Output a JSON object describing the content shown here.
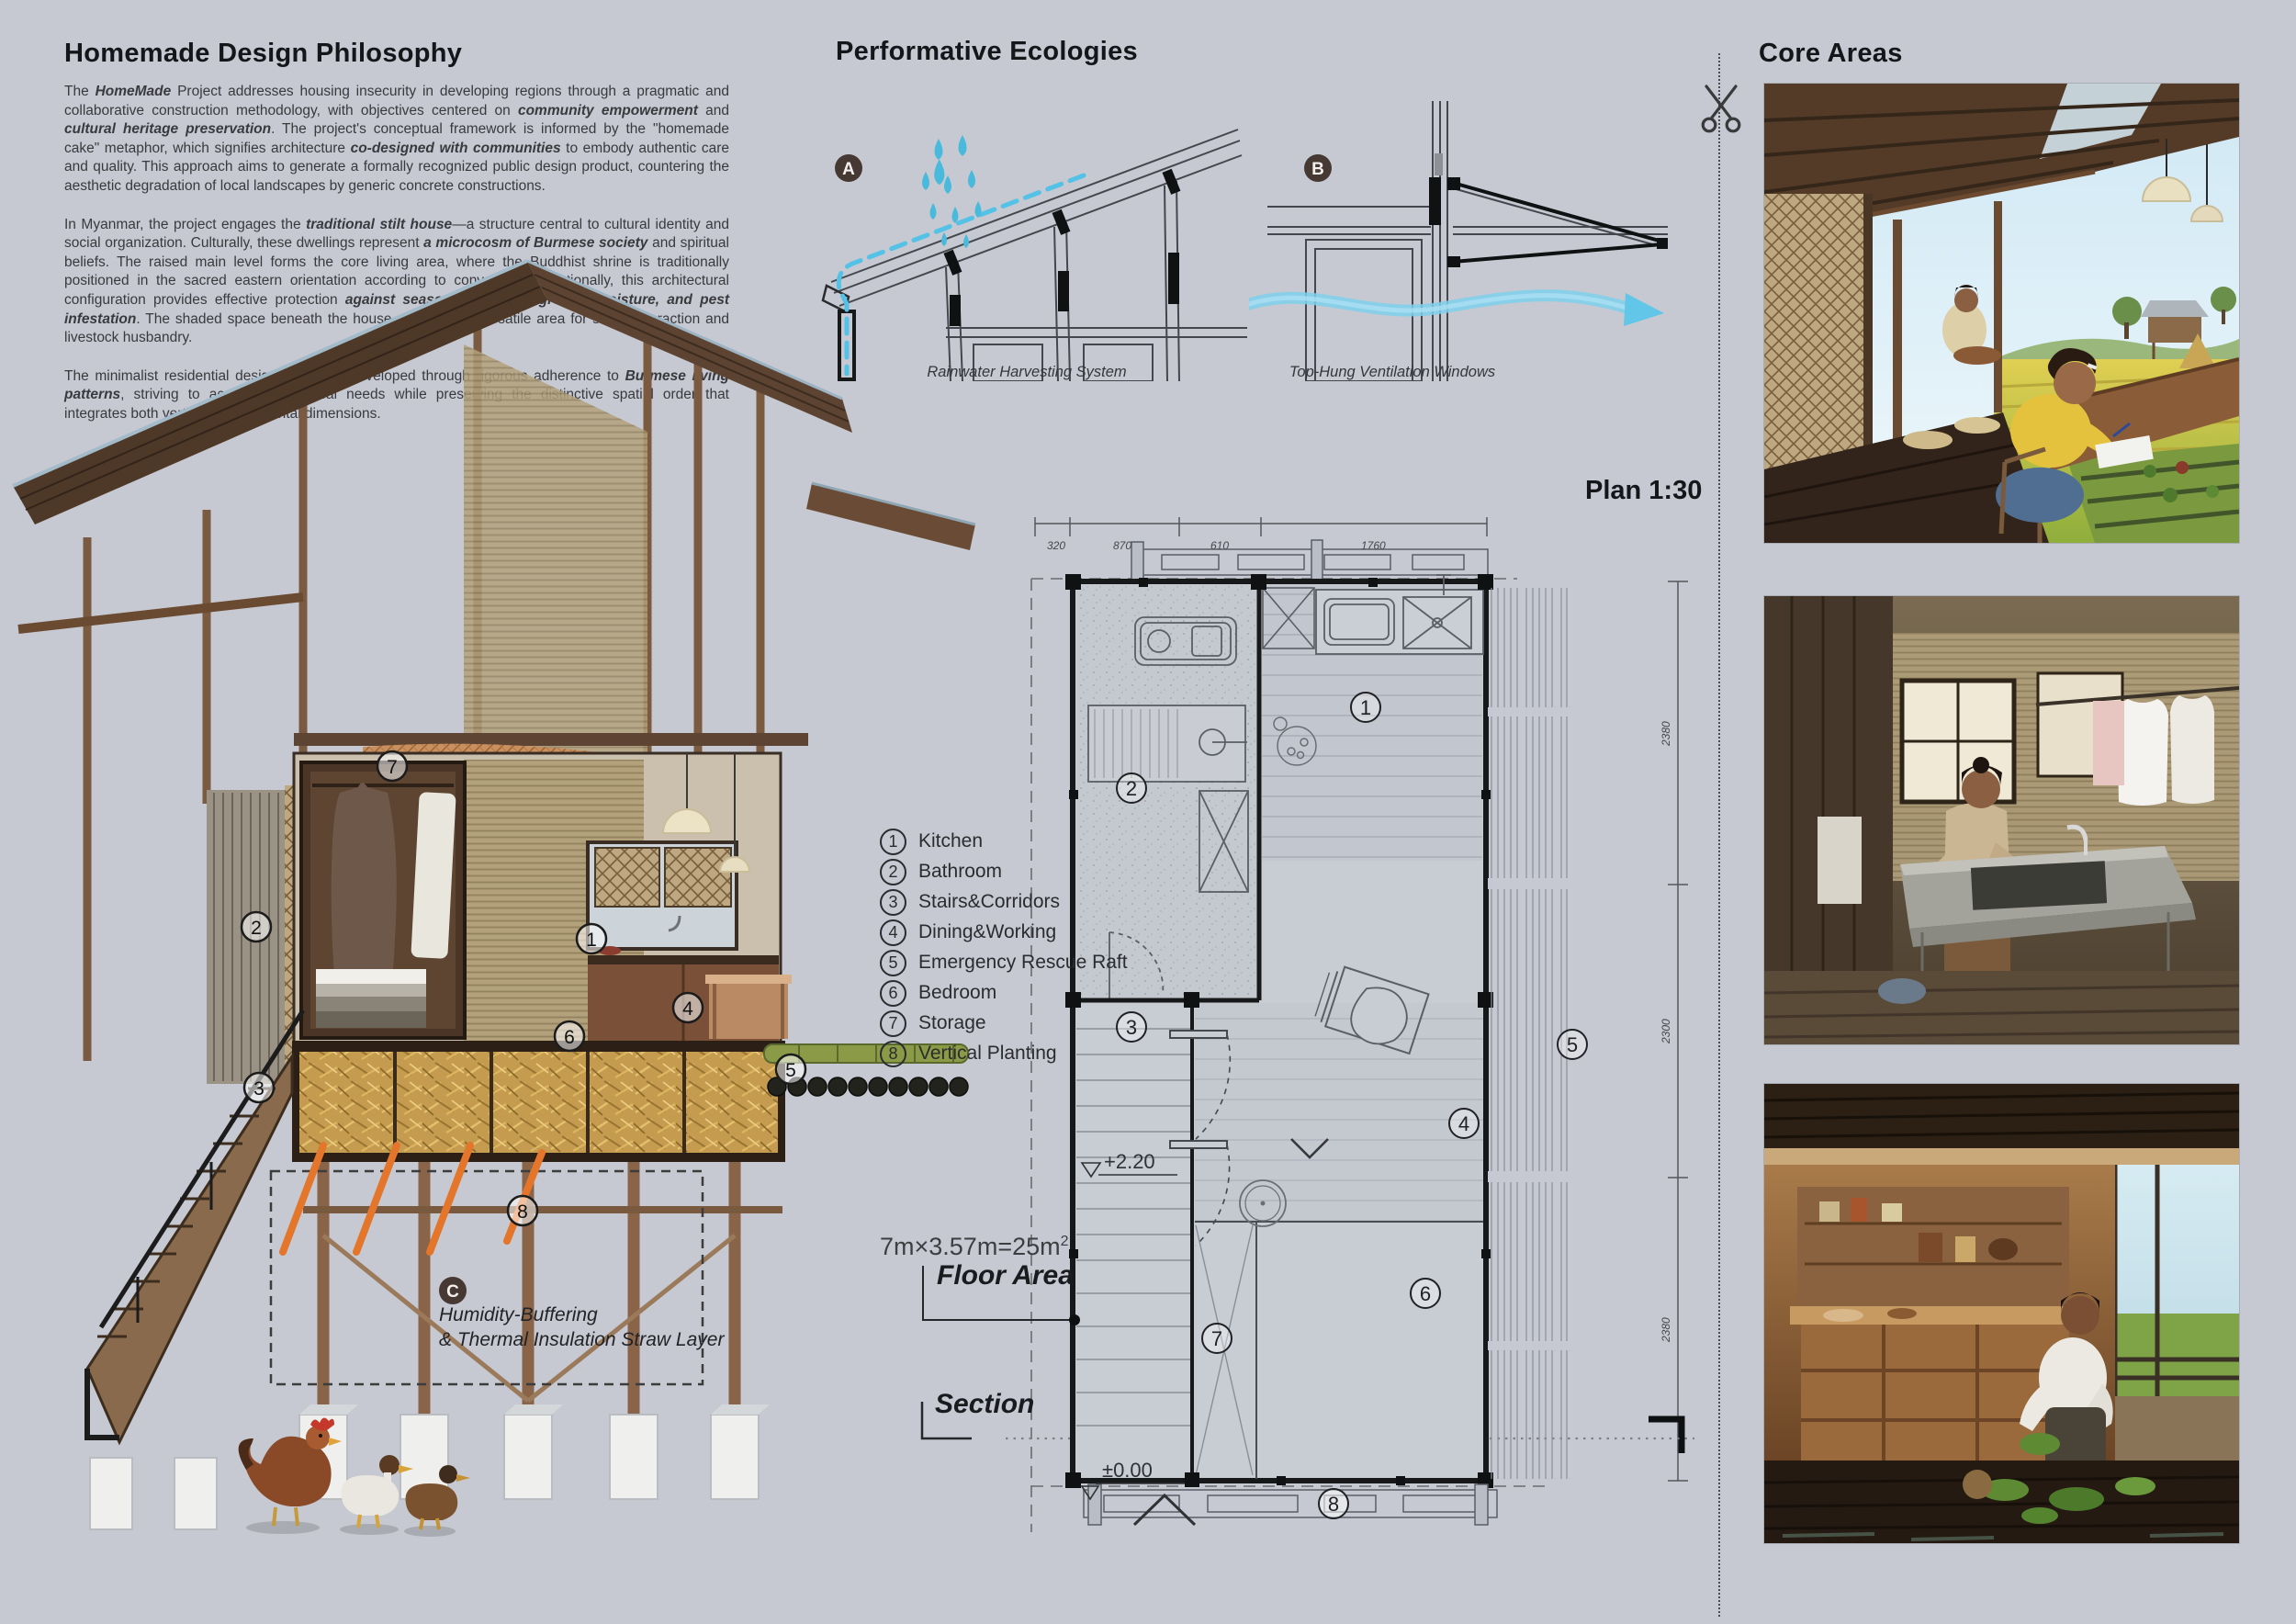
{
  "philosophy": {
    "title": "Homemade Design Philosophy",
    "p1": [
      {
        "t": "The "
      },
      {
        "t": "HomeMade"
      },
      {
        "t": " Project addresses housing insecurity in developing regions through a pragmatic and collaborative construction methodology, with objectives centered on "
      },
      {
        "t": "community empowerment"
      },
      {
        "t": " and "
      },
      {
        "t": "cultural heritage preservation"
      },
      {
        "t": ". The project's conceptual framework is informed by the \"homemade cake\" metaphor, which signifies architecture "
      },
      {
        "t": "co-designed with communities"
      },
      {
        "t": " to embody authentic care and quality. This approach aims to generate a formally recognized public design product, countering the aesthetic degradation of local landscapes by generic concrete constructions."
      }
    ],
    "p2": [
      {
        "t": "In Myanmar, the project engages the "
      },
      {
        "t": "traditional stilt house"
      },
      {
        "t": "—a structure central to cultural identity and social organization. Culturally, these dwellings represent "
      },
      {
        "t": "a microcosm of Burmese society"
      },
      {
        "t": " and spiritual beliefs. The raised main level forms the core living area, where the Buddhist shrine is traditionally positioned in the sacred eastern orientation according to convention. Functionally, this architectural configuration provides effective protection "
      },
      {
        "t": "against seasonal flooding, ground moisture, and pest infestation"
      },
      {
        "t": ". The shaded space beneath the house serves as a versatile area for social interaction and livestock husbandry."
      }
    ],
    "p3": [
      {
        "t": "The minimalist residential design has been developed through rigorous adherence to "
      },
      {
        "t": "Burmese living patterns"
      },
      {
        "t": ", striving to accommodate local needs while preserving the distinctive spatial order that integrates both vertical and horizontal dimensions."
      }
    ]
  },
  "ecologies": {
    "title": "Performative Ecologies",
    "a_label": "A",
    "a_caption": "Rainwater Harvesting System",
    "b_label": "B",
    "b_caption": "Top-Hung Ventilation Windows"
  },
  "plan": {
    "title": "Plan 1:30",
    "legend": [
      {
        "num": "1",
        "label": "Kitchen"
      },
      {
        "num": "2",
        "label": "Bathroom"
      },
      {
        "num": "3",
        "label": "Stairs&Corridors"
      },
      {
        "num": "4",
        "label": "Dining&Working"
      },
      {
        "num": "5",
        "label": "Emergency Rescue Raft"
      },
      {
        "num": "6",
        "label": "Bedroom"
      },
      {
        "num": "7",
        "label": "Storage"
      },
      {
        "num": "8",
        "label": "Vertical Planting"
      }
    ],
    "dims_top": [
      "320",
      "870",
      "610",
      "1760"
    ],
    "dims_right": [
      "2380",
      "2300",
      "2380"
    ],
    "level_upper": "+2.20",
    "level_ground": "±0.00",
    "floor_area": {
      "formula": "7m×3.57m=25m",
      "sup": "2",
      "label": "Floor Area"
    },
    "section_label": "Section"
  },
  "render": {
    "markers": [
      "1",
      "2",
      "3",
      "4",
      "5",
      "6",
      "7",
      "8"
    ],
    "c_label": "C",
    "c_line1": "Humidity-Buffering",
    "c_line2": "& Thermal Insulation Straw Layer"
  },
  "core_areas": {
    "title": "Core Areas"
  },
  "colors": {
    "background": "#c6c9d1",
    "water_blue": "#54c2e6",
    "wind_blue": "#7fd0ec",
    "badge_brown": "#463832",
    "straw": "#c59c4f",
    "heat_orange": "#e4762b"
  }
}
